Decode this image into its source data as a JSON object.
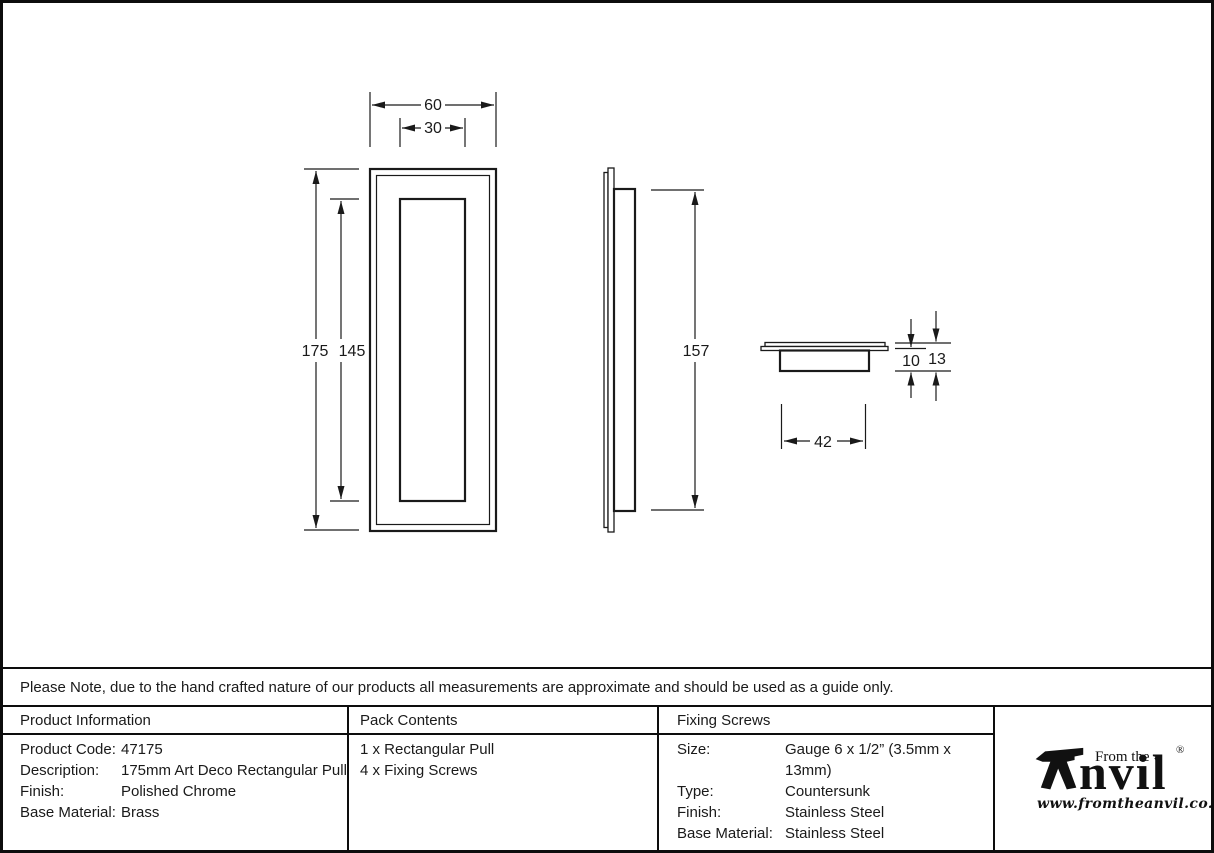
{
  "sheet": {
    "note": "Please Note, due to the hand crafted nature of our products all measurements are approximate and should be used as a guide only."
  },
  "drawing": {
    "dims": {
      "front_width": "60",
      "recess_width": "30",
      "front_height": "175",
      "recess_height": "145",
      "side_height": "157",
      "cup_width": "42",
      "cup_depth": "10",
      "total_depth": "13"
    }
  },
  "table": {
    "product_info": {
      "header": "Product Information",
      "rows": [
        {
          "label": "Product Code:",
          "value": "47175"
        },
        {
          "label": "Description:",
          "value": "175mm Art Deco Rectangular Pull"
        },
        {
          "label": "Finish:",
          "value": "Polished Chrome"
        },
        {
          "label": "Base Material:",
          "value": "Brass"
        }
      ]
    },
    "pack_contents": {
      "header": "Pack Contents",
      "items": [
        "1 x Rectangular Pull",
        "4 x Fixing Screws"
      ]
    },
    "fixing_screws": {
      "header": "Fixing Screws",
      "rows": [
        {
          "label": "Size:",
          "value": "Gauge 6 x 1/2” (3.5mm x 13mm)"
        },
        {
          "label": "Type:",
          "value": "Countersunk"
        },
        {
          "label": "Finish:",
          "value": "Stainless Steel"
        },
        {
          "label": "Base Material:",
          "value": "Stainless Steel"
        }
      ]
    }
  },
  "logo": {
    "from_the": "From the",
    "brand_rest": "nvil",
    "diamond": "♦",
    "registered": "®",
    "website": "www.fromtheanvil.co.uk"
  }
}
